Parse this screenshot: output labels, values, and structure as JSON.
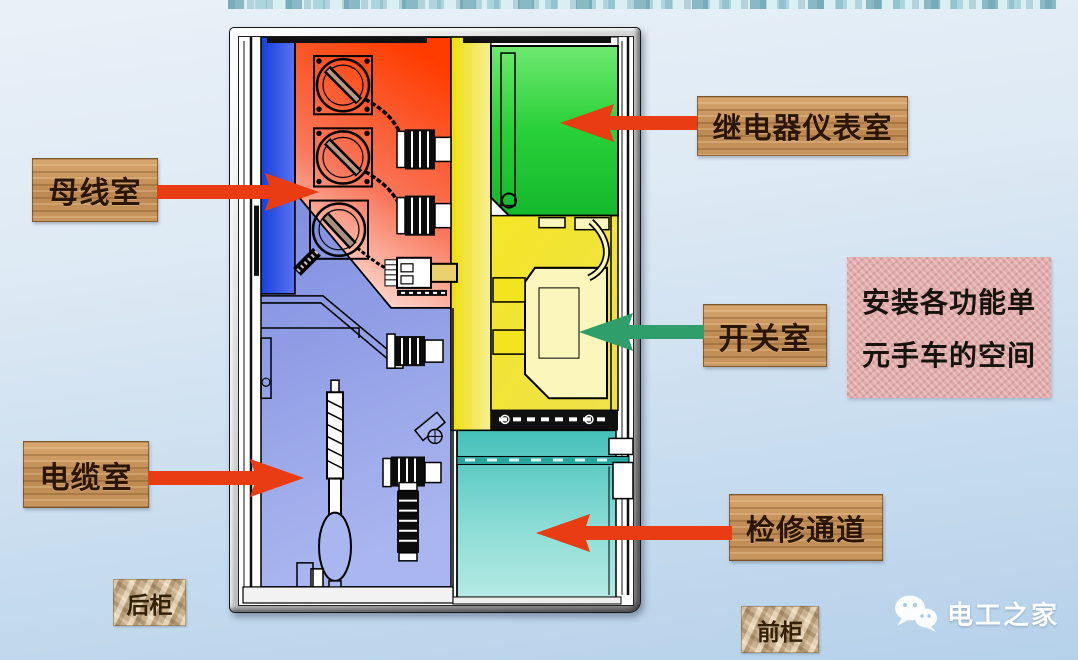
{
  "slide": {
    "background_top": "#e7eff8",
    "background_bottom": "#b5d1ea"
  },
  "banner": {
    "name": "decorative-header-strip",
    "color": "#d9eff1"
  },
  "callouts": {
    "busbar": {
      "label": "母线室",
      "arrow_color": "#e93c12",
      "arrow_direction": "right"
    },
    "relay": {
      "label": "继电器仪表室",
      "arrow_color": "#e93c12",
      "arrow_direction": "left"
    },
    "switch": {
      "label": "开关室",
      "arrow_color": "#2f9e6a",
      "arrow_direction": "left"
    },
    "cable": {
      "label": "电缆室",
      "arrow_color": "#e93c12",
      "arrow_direction": "right"
    },
    "passage": {
      "label": "检修通道",
      "arrow_color": "#e93c12",
      "arrow_direction": "left"
    }
  },
  "note": {
    "line1": "安装各功能单",
    "line2": "元手车的空间",
    "background": "#e3acac"
  },
  "cabinet_tags": {
    "rear": "后柜",
    "front": "前柜"
  },
  "watermark": {
    "brand": "电工之家",
    "icon": "wechat-icon"
  },
  "diagram": {
    "subject": "switchgear-cabinet-cross-section",
    "compartments": [
      {
        "name": "busbar-compartment",
        "color": "#ff3c00"
      },
      {
        "name": "relay-instrument-compartment",
        "color": "#2ed23e"
      },
      {
        "name": "switch-compartment",
        "color": "#f2e41e"
      },
      {
        "name": "cable-compartment",
        "color": "#8b99e6"
      },
      {
        "name": "maintenance-passage",
        "color": "#5ec9c2"
      },
      {
        "name": "busbar-side-panel",
        "color": "#2a52ee"
      }
    ]
  }
}
